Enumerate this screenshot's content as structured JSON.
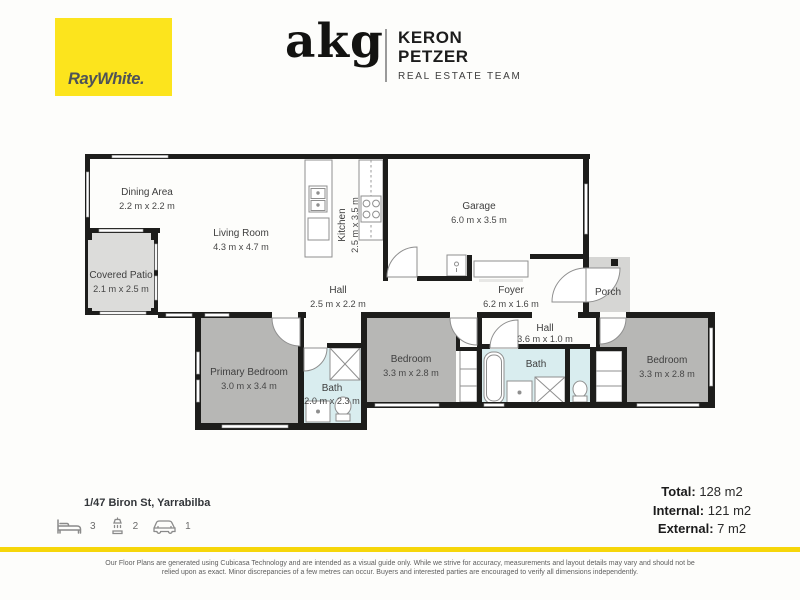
{
  "header": {
    "raywhite_logo": "RayWhite.",
    "agency_logo": "akg",
    "team_line1": "KERON",
    "team_line2": "PETZER",
    "team_subtitle": "REAL ESTATE TEAM"
  },
  "colors": {
    "brand_yellow": "#fce41d",
    "divider_yellow": "#f6d60a",
    "wall_black": "#1d1d1b",
    "bedroom_gray": "#b7b7b5",
    "outdoor_gray": "#dcdcda",
    "bath_blue": "#d9edef"
  },
  "plan": {
    "dining": {
      "name": "Dining Area",
      "dims": "2.2 m x 2.2 m"
    },
    "living": {
      "name": "Living Room",
      "dims": "4.3 m x 4.7 m"
    },
    "kitchen": {
      "name": "Kitchen",
      "dims": "2.5 m x 3.5 m"
    },
    "garage": {
      "name": "Garage",
      "dims": "6.0 m x 3.5 m"
    },
    "patio": {
      "name": "Covered Patio",
      "dims": "2.1 m x 2.5 m"
    },
    "hall_main": {
      "name": "Hall",
      "dims": "2.5 m x 2.2 m"
    },
    "foyer": {
      "name": "Foyer",
      "dims": "6.2 m x 1.6 m"
    },
    "porch": {
      "name": "Porch"
    },
    "hall_bed": {
      "name": "Hall",
      "dims": "3.6 m x 1.0 m"
    },
    "bed_primary": {
      "name": "Primary Bedroom",
      "dims": "3.0 m x 3.4 m"
    },
    "bath_one": {
      "name": "Bath",
      "dims": "2.0 m x 2.3 m"
    },
    "bed_mid": {
      "name": "Bedroom",
      "dims": "3.3 m x 2.8 m"
    },
    "bath_two": {
      "name": "Bath"
    },
    "bed_right": {
      "name": "Bedroom",
      "dims": "3.3 m x 2.8 m"
    }
  },
  "footer": {
    "address": "1/47 Biron St, Yarrabilba",
    "features": {
      "beds": "3",
      "baths": "2",
      "cars": "1"
    },
    "areas": [
      {
        "label": "Total:",
        "value": "128 m2"
      },
      {
        "label": "Internal:",
        "value": "121 m2"
      },
      {
        "label": "External:",
        "value": "7 m2"
      }
    ],
    "disclaimer_line1": "Our Floor Plans are generated using Cubicasa Technology and are intended as a visual guide only. While we strive for accuracy, measurements and layout details may vary and should not be",
    "disclaimer_line2": "relied upon as exact. Minor discrepancies of a few metres can occur. Buyers and interested parties are encouraged to verify all dimensions independently."
  }
}
